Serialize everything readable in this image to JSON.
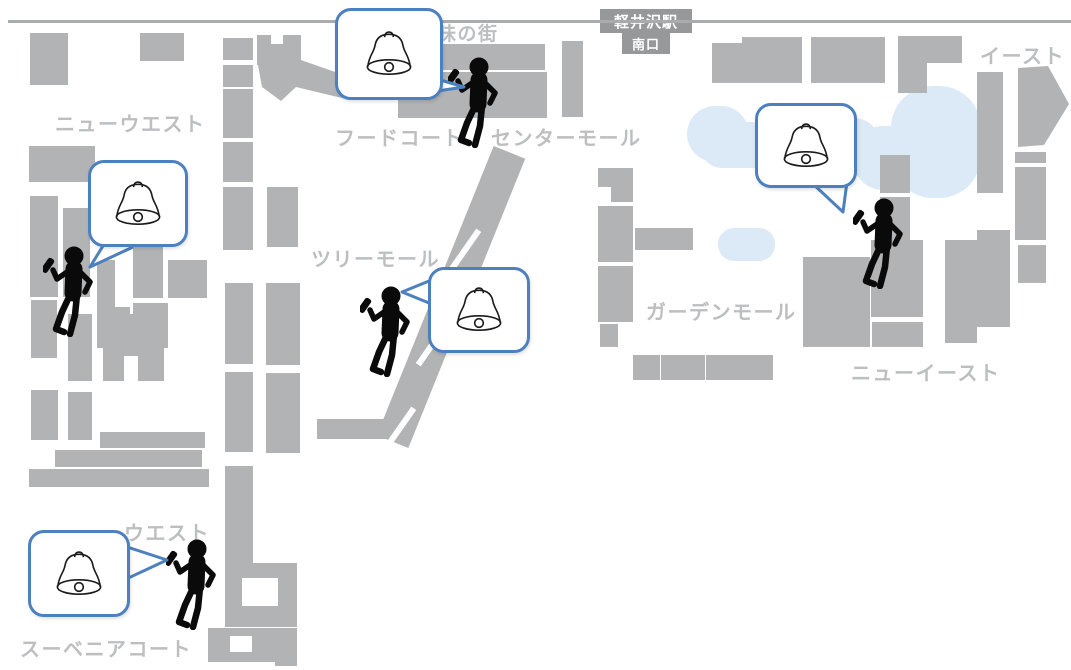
{
  "map": {
    "colors": {
      "building": "#b2b3b5",
      "label": "#bdbec0",
      "road": "#a9abad",
      "badge_bg": "#97989a",
      "badge_text": "#ffffff",
      "bubble_border": "#4d80be",
      "bubble_fill": "#ffffff",
      "pond": "#dceaf8",
      "figure": "#0a0a0a",
      "bell_stroke": "#1b1b1b",
      "outlined_building_border": "#ffffff"
    },
    "station_badge": {
      "line1": "軽井沢駅",
      "line2": "南口"
    },
    "road": {
      "x": 8,
      "y": 20,
      "width": 1063,
      "thickness": 3
    },
    "labels": [
      {
        "id": "new-west",
        "text": "ニューウエスト",
        "x": 55,
        "y": 108,
        "size": 20
      },
      {
        "id": "aji-no-machi",
        "text": "味の街",
        "x": 437,
        "y": 19,
        "size": 19
      },
      {
        "id": "food-court",
        "text": "フードコート",
        "x": 335,
        "y": 122,
        "size": 20
      },
      {
        "id": "center-mall",
        "text": "センターモール",
        "x": 491,
        "y": 122,
        "size": 20
      },
      {
        "id": "east",
        "text": "イースト",
        "x": 980,
        "y": 40,
        "size": 20
      },
      {
        "id": "tree-mall",
        "text": "ツリーモール",
        "x": 311,
        "y": 243,
        "size": 20
      },
      {
        "id": "garden-mall",
        "text": "ガーデンモール",
        "x": 646,
        "y": 296,
        "size": 20
      },
      {
        "id": "new-east",
        "text": "ニューイースト",
        "x": 851,
        "y": 357,
        "size": 20
      },
      {
        "id": "west",
        "text": "ウエスト",
        "x": 124,
        "y": 517,
        "size": 20
      },
      {
        "id": "souvenir-court",
        "text": "スーベニアコート",
        "x": 20,
        "y": 633,
        "size": 20
      }
    ],
    "buildings": [
      [
        30,
        33,
        38,
        52
      ],
      [
        140,
        33,
        44,
        28
      ],
      [
        29,
        146,
        66,
        36
      ],
      [
        30,
        196,
        28,
        101
      ],
      [
        63,
        208,
        27,
        89
      ],
      [
        97,
        260,
        18,
        77
      ],
      [
        133,
        247,
        30,
        51
      ],
      [
        168,
        260,
        39,
        38
      ],
      [
        97,
        307,
        33,
        41
      ],
      [
        133,
        303,
        35,
        45
      ],
      [
        31,
        300,
        26,
        58
      ],
      [
        31,
        390,
        27,
        50
      ],
      [
        68,
        314,
        24,
        67
      ],
      [
        68,
        392,
        24,
        48
      ],
      [
        103,
        314,
        61,
        67
      ],
      [
        100,
        432,
        105,
        16
      ],
      [
        55,
        450,
        147,
        17
      ],
      [
        29,
        469,
        180,
        18
      ],
      [
        223,
        38,
        30,
        22
      ],
      [
        223,
        65,
        30,
        22
      ],
      [
        223,
        89,
        30,
        49
      ],
      [
        223,
        142,
        30,
        40
      ],
      [
        223,
        187,
        30,
        63
      ],
      [
        225,
        283,
        28,
        81
      ],
      [
        225,
        372,
        28,
        80
      ],
      [
        225,
        466,
        28,
        97
      ],
      [
        267,
        187,
        31,
        60
      ],
      [
        266,
        283,
        34,
        82
      ],
      [
        266,
        373,
        34,
        80
      ],
      [
        257,
        35,
        44,
        30
      ],
      [
        398,
        72,
        149,
        46
      ],
      [
        562,
        41,
        21,
        76
      ],
      [
        225,
        563,
        72,
        64
      ],
      [
        208,
        628,
        89,
        34
      ],
      [
        275,
        630,
        22,
        36
      ],
      [
        598,
        168,
        35,
        34
      ],
      [
        598,
        206,
        35,
        56
      ],
      [
        598,
        266,
        35,
        56
      ],
      [
        600,
        324,
        18,
        23
      ],
      [
        635,
        228,
        58,
        22
      ],
      [
        633,
        355,
        27,
        25
      ],
      [
        661,
        355,
        44,
        25
      ],
      [
        706,
        355,
        67,
        25
      ],
      [
        317,
        419,
        78,
        20
      ],
      [
        712,
        43,
        38,
        40
      ],
      [
        742,
        37,
        60,
        46
      ],
      [
        811,
        37,
        74,
        46
      ],
      [
        898,
        36,
        64,
        27
      ],
      [
        898,
        63,
        29,
        30
      ],
      [
        977,
        72,
        26,
        121
      ],
      [
        1015,
        152,
        31,
        11
      ],
      [
        1015,
        167,
        31,
        73
      ],
      [
        1018,
        245,
        28,
        38
      ],
      [
        880,
        155,
        30,
        38
      ],
      [
        880,
        197,
        30,
        55
      ],
      [
        803,
        257,
        67,
        90
      ],
      [
        871,
        240,
        52,
        77
      ],
      [
        872,
        322,
        51,
        25
      ],
      [
        945,
        240,
        32,
        103
      ],
      [
        977,
        230,
        33,
        97
      ]
    ],
    "holes": [
      [
        271,
        35,
        12,
        9
      ],
      [
        124,
        356,
        14,
        26
      ],
      [
        598,
        187,
        13,
        16
      ],
      [
        242,
        578,
        36,
        28
      ],
      [
        230,
        636,
        22,
        16
      ]
    ],
    "polygons": [
      {
        "id": "food-court-chevron",
        "points": "258,65 298,59 358,80 350,100 296,87 281,101 262,87"
      },
      {
        "id": "east-arrow",
        "points": "1018,68 1048,66 1069,104 1044,145 1018,147"
      }
    ],
    "outlined_building": {
      "x": 437,
      "y": 42,
      "w": 110,
      "h": 30
    },
    "walkway": {
      "left": 434,
      "top": 141,
      "w": 34,
      "len": 312,
      "angle": 22,
      "gaps": [
        [
          465,
          250
        ],
        [
          432,
          345
        ],
        [
          400,
          428
        ]
      ]
    },
    "pond_blobs": [
      [
        687,
        106,
        62,
        56,
        28
      ],
      [
        700,
        122,
        108,
        46,
        22
      ],
      [
        788,
        118,
        92,
        52,
        26
      ],
      [
        853,
        126,
        80,
        64,
        30
      ],
      [
        891,
        86,
        90,
        112,
        42
      ],
      [
        718,
        228,
        57,
        33,
        16
      ]
    ],
    "markers": [
      {
        "id": "marker-food-court",
        "icon": "bell-icon",
        "person": [
          448,
          56
        ],
        "bubble": [
          335,
          8,
          108,
          92
        ],
        "tail": "M420,74 L464,87 L404,96"
      },
      {
        "id": "marker-new-west",
        "icon": "bell-icon",
        "person": [
          43,
          245
        ],
        "bubble": [
          88,
          160,
          100,
          87
        ],
        "tail": "M106,241 L90,267 L133,247"
      },
      {
        "id": "marker-tree-mall",
        "icon": "bell-icon",
        "person": [
          360,
          285
        ],
        "bubble": [
          428,
          267,
          102,
          86
        ],
        "tail": "M434,279 L402,292 L434,305"
      },
      {
        "id": "marker-east",
        "icon": "bell-icon",
        "person": [
          853,
          197
        ],
        "bubble": [
          755,
          103,
          102,
          85
        ],
        "tail": "M812,183 L843,212 L847,182"
      },
      {
        "id": "marker-west",
        "icon": "bell-icon",
        "person": [
          166,
          538
        ],
        "bubble": [
          28,
          530,
          102,
          87
        ],
        "tail": "M124,546 L167,560 L124,580"
      }
    ]
  }
}
